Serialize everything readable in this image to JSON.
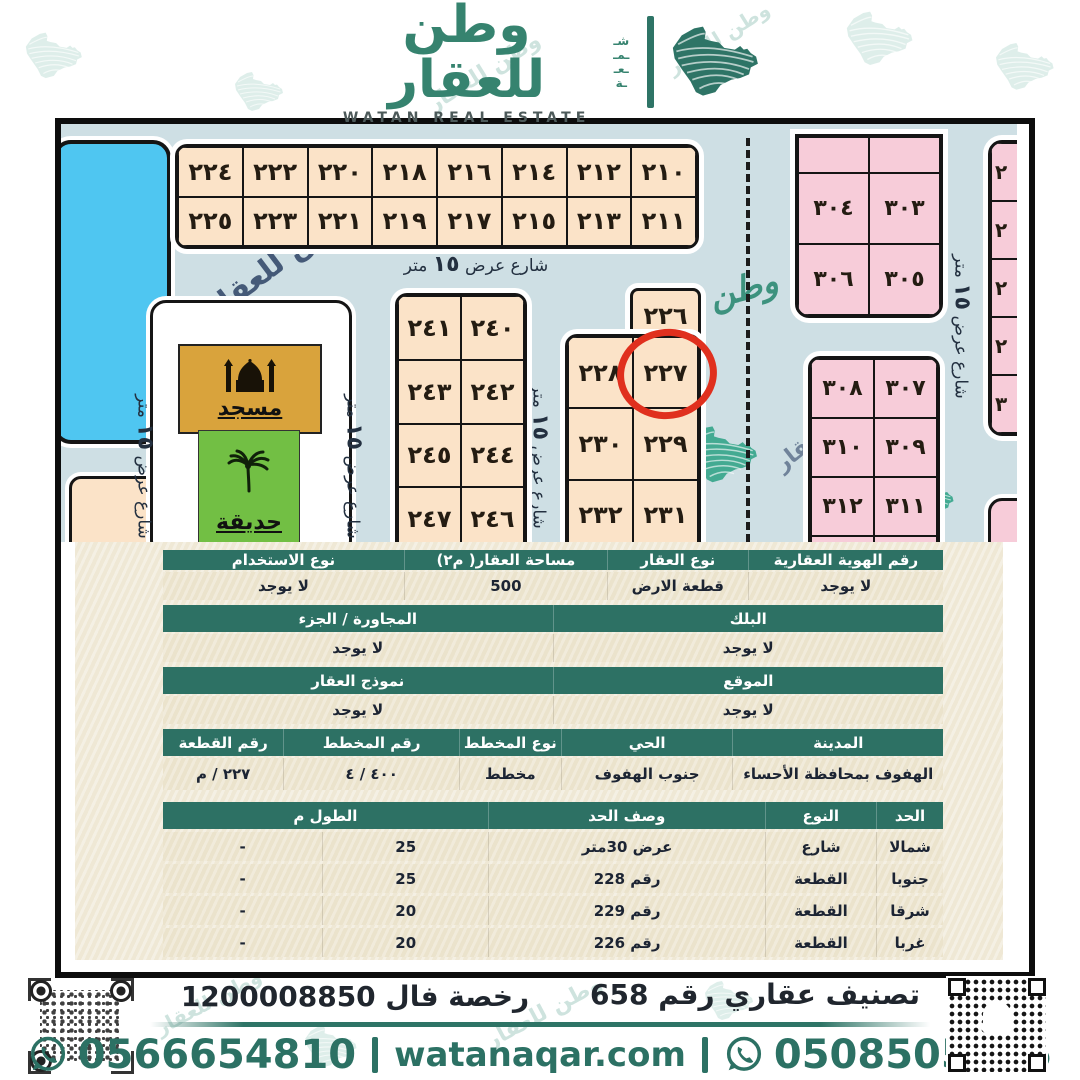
{
  "brand": {
    "name_ar": "وطن للعقار",
    "name_en": "WATAN REAL ESTATE",
    "side_letters": [
      "شـ",
      "ـمـ",
      "ـعـ",
      "ـة"
    ]
  },
  "colors": {
    "accent_teal": "#2e7466",
    "header_green": "#2d7164",
    "map_background": "#cedfe4",
    "plot_beige": "#fbe3c8",
    "plot_pink": "#f7ccd9",
    "pool_blue": "#4fc6f1",
    "mosque_gold": "#d9a33c",
    "garden_green": "#72bf44",
    "highlight_red": "#e0301e"
  },
  "map": {
    "street": {
      "pre": "شارع عرض",
      "num": "١٥",
      "post": "متر"
    },
    "mosque_label": "مسجد",
    "garden_label": "حديقة",
    "circled_plot": "٢٢٧",
    "watermark_text_1": "وطن للعقار",
    "watermark_text_2": "للعقار",
    "watermark_text_3": "طن للعقار",
    "watermark_script": "وطن",
    "blocks": {
      "top_left": {
        "rows": [
          [
            "٢٢٤",
            "٢٢٢",
            "٢٢٠",
            "٢١٨",
            "٢١٦",
            "٢١٤",
            "٢١٢",
            "٢١٠"
          ],
          [
            "٢٢٥",
            "٢٢٣",
            "٢٢١",
            "٢١٩",
            "٢١٧",
            "٢١٥",
            "٢١٣",
            "٢١١"
          ]
        ]
      },
      "mid_left": {
        "rows": [
          [
            "٢٤١",
            "٢٤٠"
          ],
          [
            "٢٤٣",
            "٢٤٢"
          ],
          [
            "٢٤٥",
            "٢٤٤"
          ],
          [
            "٢٤٧",
            "٢٤٦"
          ]
        ]
      },
      "mid_right": {
        "top": "٢٢٦",
        "rows": [
          [
            "٢٢٨",
            "٢٢٧"
          ],
          [
            "٢٣٠",
            "٢٢٩"
          ],
          [
            "٢٣٢",
            "٢٣١"
          ]
        ]
      },
      "pink_top": {
        "rows": [
          [
            "",
            ""
          ],
          [
            "٣٠٤",
            "٣٠٣"
          ],
          [
            "٣٠٦",
            "٣٠٥"
          ]
        ]
      },
      "pink_bottom": {
        "rows": [
          [
            "٣٠٨",
            "٣٠٧"
          ],
          [
            "٣١٠",
            "٣٠٩"
          ],
          [
            "٣١٢",
            "٣١١"
          ],
          [
            "",
            ""
          ]
        ]
      },
      "right_column": {
        "rows": [
          [
            "٢"
          ],
          [
            "٢"
          ],
          [
            "٢"
          ],
          [
            "٢"
          ],
          [
            "٣"
          ]
        ]
      }
    }
  },
  "deed": {
    "r1h": [
      "رقم الهوية العقارية",
      "نوع العقار",
      "مساحة العقار( م٢)",
      "نوع الاستخدام"
    ],
    "r1v": [
      "لا يوجد",
      "قطعة الارض",
      "500",
      "لا يوجد"
    ],
    "r2h": [
      "البلك",
      "المجاورة / الجزء"
    ],
    "r2v": [
      "لا يوجد",
      "لا يوجد"
    ],
    "r3h": [
      "الموقع",
      "نموذج العقار"
    ],
    "r3v": [
      "لا يوجد",
      "لا يوجد"
    ],
    "r4h": [
      "المدينة",
      "الحي",
      "نوع المخطط",
      "رقم المخطط",
      "رقم القطعة"
    ],
    "r4v": [
      "الهفوف بمحافظة الأحساء",
      "جنوب الهفوف",
      "مخطط",
      "٤٠٠ / ٤",
      "٢٢٧ / م"
    ],
    "bh": [
      "الحد",
      "النوع",
      "وصف الحد",
      "الطول م"
    ],
    "b1": [
      "شمالا",
      "شارع",
      "عرض 30متر",
      "25",
      "-"
    ],
    "b2": [
      "جنوبا",
      "القطعة",
      "رقم 228",
      "25",
      "-"
    ],
    "b3": [
      "شرقا",
      "القطعة",
      "رقم 229",
      "20",
      "-"
    ],
    "b4": [
      "غربا",
      "القطعة",
      "رقم 226",
      "20",
      "-"
    ]
  },
  "footer": {
    "license": "رخصة فال 1200008850",
    "classification": "تصنيف عقاري رقم 658",
    "phone_left": "0566654810",
    "phone_right": "0508505505",
    "website": "watanaqar.com"
  }
}
